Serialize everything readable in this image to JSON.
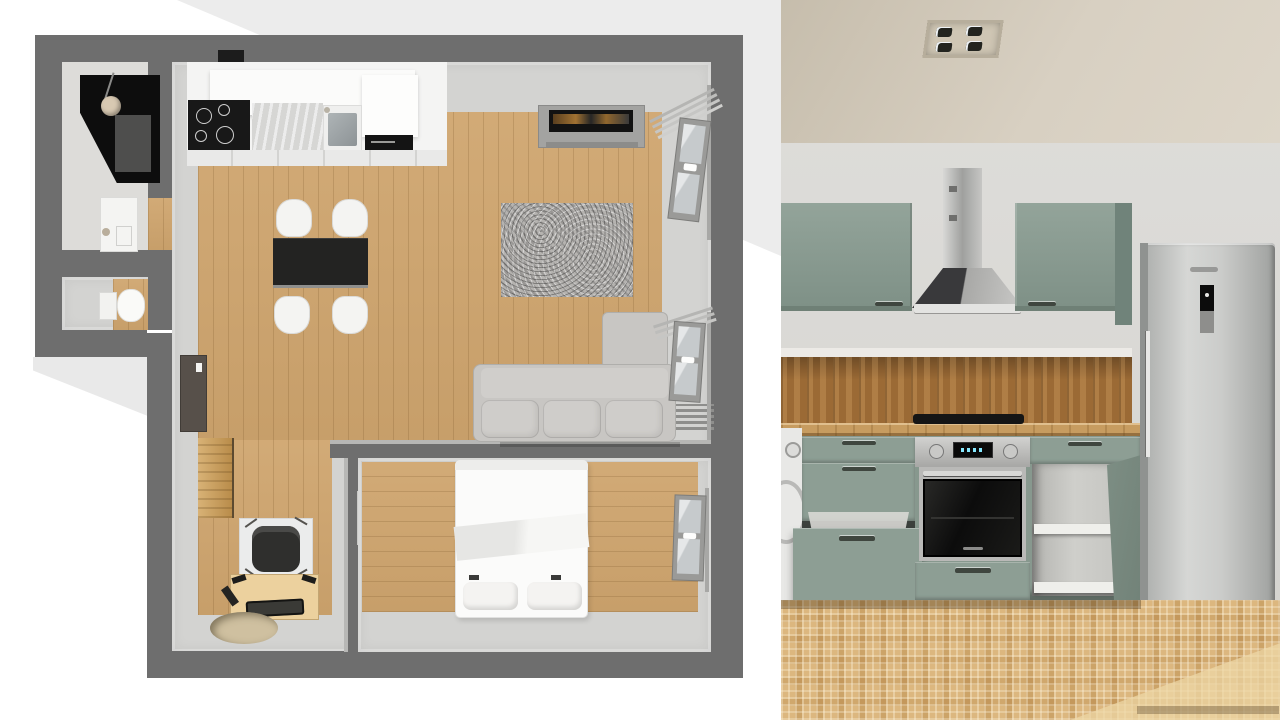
{
  "meta": {
    "title": "Apartment floor plan (top-down 3D) beside 3D kitchen render",
    "width_px": 1280,
    "height_px": 720,
    "visible_text": "none (no readable UI text in image)"
  },
  "floor_plan_panel": {
    "view": "top-down 3D floor plan",
    "background_color": "#ffffff",
    "backdrop_wedge_color": "#ececec",
    "wall_color": "#6e6e6e",
    "floor_colors": {
      "walkway": "#d3d3d1",
      "wood": "#cfa56e"
    },
    "rooms": [
      {
        "name": "bathroom",
        "furniture": [
          "corner-shower (black) with shower head",
          "washbasin with faucet",
          "door opening with wood threshold"
        ]
      },
      {
        "name": "wc",
        "furniture": [
          "toilet with cistern",
          "wood floor patch"
        ]
      },
      {
        "name": "kitchen-living-room",
        "furniture": [
          "kitchen counter run: cooktop with 4 burners, marble worktop, sink, black built-in appliance, white wall cabinets, extractor mark on wall",
          "dining table (black top) with 4 white chairs",
          "tv sideboard (grey) with flat tv",
          "grey shag rug",
          "corner sofa with chaise (light grey)",
          "radiator under window",
          "entry door (dark brown, open)",
          "tall wooden cabinet",
          "desk (light wood) with black office chair on floor mat",
          "round beige rug"
        ]
      },
      {
        "name": "bedroom",
        "furniture": [
          "double bed (white) with duvet and two pillows",
          "open white interior door",
          "window with mounting rail"
        ]
      }
    ],
    "windows": [
      {
        "name": "window-top-right",
        "state": "tilted open"
      },
      {
        "name": "window-middle-right",
        "state": "tilted open, radiator below"
      },
      {
        "name": "window-bedroom",
        "state": "closed"
      }
    ]
  },
  "kitchen_render_panel": {
    "view": "3D interior render of kitchen wall",
    "ceiling_color": "#d2cabb",
    "wall_color": "#dcdbd7",
    "cabinet_color": "#8d9e94",
    "countertop_color": "#c79c60",
    "backsplash_color": "#9b6a35",
    "floor_color": "#dcb77f",
    "elements": [
      "recessed ceiling light panel with 4 spots",
      "stainless chimney extractor hood with dark glass canopy",
      "upper cabinets (sage green) left and right of hood, with dark handles",
      "cork / wood backsplash",
      "black induction cooktop on wooden countertop",
      "washing machine (partially visible at left edge)",
      "drawer base unit with bottom drawer pulled open",
      "built-in oven: steel control strip, black display, two knobs, black glass door, illegible brand badge",
      "base cabinet with open sage-green door showing white shelves",
      "stainless fridge-freezer with vertical handle, black control panel and illegible brand logo",
      "beige mosaic tile floor with light sheen at bottom right"
    ]
  }
}
